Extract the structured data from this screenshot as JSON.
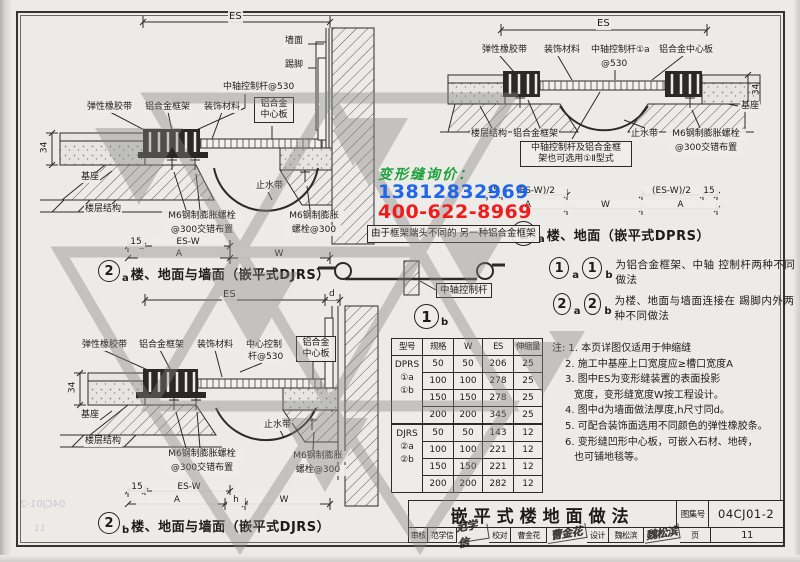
{
  "watermark": {
    "inquiry": "变形缝询价：",
    "phone1": "13812832969",
    "phone2": "400-622-8969"
  },
  "ghost": {
    "atlas": "04CJ01-2",
    "page": "11"
  },
  "d2a": {
    "dim_es": "ES",
    "dim_34": "34",
    "dim_15": "15",
    "dim_esw": "ES-W",
    "dim_a": "A",
    "dim_w": "W",
    "wall": "墙面",
    "skirt": "踢脚",
    "rod": "中轴控制杆@530",
    "rubber": "弹性橡胶带",
    "frame": "铝合金框架",
    "finish": "装饰材料",
    "center1": "铝合金",
    "center2": "中心板",
    "base": "基座",
    "water": "止水带",
    "floor": "楼层结构",
    "bolt1a": "M6钢制膨胀螺栓",
    "bolt1b": "@300交错布置",
    "bolt2a": "M6钢制膨胀",
    "bolt2b": "螺栓@300",
    "num": "2",
    "sub": "a",
    "caption": "楼、地面与墙面（嵌平式DJRS）"
  },
  "d2b": {
    "dim_es": "ES",
    "dim_d": "d",
    "dim_34": "34",
    "dim_15": "15",
    "dim_esw": "ES-W",
    "dim_a": "A",
    "dim_h": "h",
    "dim_w": "W",
    "rubber": "弹性橡胶带",
    "frame": "铝合金框架",
    "finish": "装饰材料",
    "rod1": "中心控制",
    "rod2": "杆@530",
    "center1": "铝合金",
    "center2": "中心板",
    "base": "基座",
    "water": "止水带",
    "floor": "楼层结构",
    "bolt1a": "M6钢制膨胀螺栓",
    "bolt1b": "@300交错布置",
    "bolt2a": "M6钢制膨胀",
    "bolt2b": "螺栓@300",
    "num": "2",
    "sub": "b",
    "caption": "楼、地面与墙面（嵌平式DJRS）"
  },
  "d1a": {
    "dim_es": "ES",
    "dim_34": "34",
    "dim_15": "15",
    "dim_esw2": "(ES-W)/2",
    "dim_a": "A",
    "dim_w": "W",
    "rubber": "弹性橡胶带",
    "finish": "装饰材料",
    "rod1": "中轴控制杆①a",
    "rod2": "@530",
    "center": "铝合金中心板",
    "base": "基座",
    "floor": "楼层结构",
    "frame": "铝合金框架",
    "water": "止水带",
    "bolt1a": "M6钢制膨胀螺栓",
    "bolt1b": "@300交错布置",
    "alt1": "中轴控制杆及铝合金框",
    "alt2": "架也可选用①Ⅱ型式",
    "num": "1",
    "sub": "a",
    "caption": "楼、地面（嵌平式DPRS）"
  },
  "d1b": {
    "note1": "由于框架端头不同的",
    "note2": "另一种铝合金框架",
    "rod": "中轴控制杆",
    "num": "1",
    "sub": "b"
  },
  "legend": {
    "r1": {
      "n": "1",
      "s1": "a",
      "s2": "b",
      "t1": "为铝合金框架、中轴",
      "t2": "控制杆两种不同做法"
    },
    "r2": {
      "n": "2",
      "s1": "a",
      "s2": "b",
      "t1": "为楼、地面与墙面连接在",
      "t2": "踢脚内外两种不同做法"
    }
  },
  "table": {
    "headers": [
      "型号",
      "规格",
      "W",
      "ES",
      "伸缩量"
    ],
    "g1": {
      "name": "DPRS",
      "s1": "①a",
      "s2": "①b",
      "rows": [
        [
          "50",
          "50",
          "206",
          "25"
        ],
        [
          "100",
          "100",
          "278",
          "25"
        ],
        [
          "150",
          "150",
          "278",
          "25"
        ],
        [
          "200",
          "200",
          "345",
          "25"
        ]
      ]
    },
    "g2": {
      "name": "DJRS",
      "s1": "②a",
      "s2": "②b",
      "rows": [
        [
          "50",
          "50",
          "143",
          "12"
        ],
        [
          "100",
          "100",
          "221",
          "12"
        ],
        [
          "150",
          "150",
          "221",
          "12"
        ],
        [
          "200",
          "200",
          "282",
          "12"
        ]
      ]
    }
  },
  "notes": {
    "tag": "注:",
    "l1": "1. 本页详图仅适用于伸缩缝",
    "l2": "2. 施工中基座上口宽度应≥槽口宽度A",
    "l3": "3. 图中ES为变形缝装置的表面投影",
    "l3b": "宽度，变形缝宽度W按工程设计。",
    "l4": "4. 图中d为墙面做法厚度,h尺寸同d。",
    "l5": "5. 可配合装饰面选用不同颜色的弹性橡胶条。",
    "l6": "6. 变形缝凹形中心板，可嵌入石材、地砖，",
    "l6b": "也可铺地毯等。"
  },
  "tb": {
    "title": "嵌平式楼地面做法",
    "atlas_label": "图集号",
    "atlas_no": "04CJ01-2",
    "audit": "审核",
    "auditor": "范学信",
    "audit_sig": "范学信",
    "proof": "校对",
    "proofer": "曹金花",
    "proof_sig": "曹金花",
    "design": "设计",
    "designer": "魏松滨",
    "design_sig": "魏松滨",
    "page": "页",
    "page_no": "11"
  }
}
